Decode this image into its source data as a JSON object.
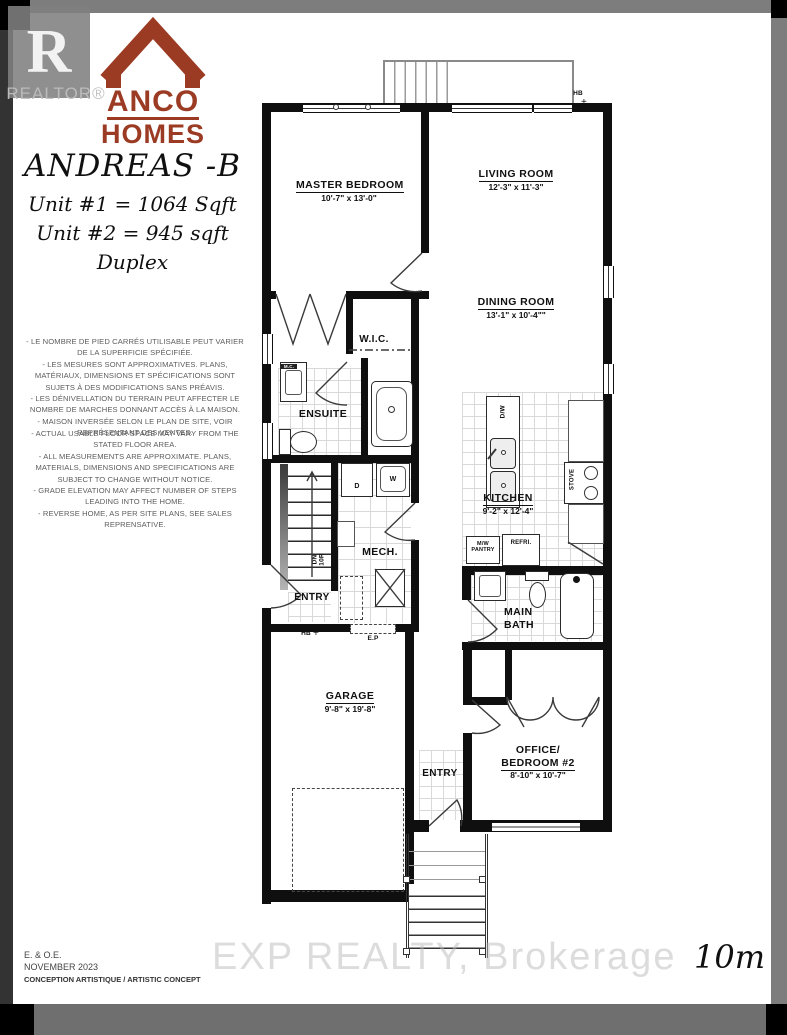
{
  "branding": {
    "realtor_r": "R",
    "realtor_label": "REALTOR®",
    "builder_name_line1": "ANCO",
    "builder_name_line2": "HOMES",
    "logo_color": "#9c3b23"
  },
  "titleblock": {
    "model_name": "ANDREAS -B",
    "unit1_area": "Unit #1 = 1064 Sqft",
    "unit2_area": "Unit #2 = 945 sqft",
    "plan_type": "Duplex"
  },
  "disclaimer": {
    "french": "- LE NOMBRE DE PIED CARRÉS UTILISABLE PEUT VARIER DE LA SUPERFICIE SPÉCIFIÉE.\n- LES MESURES SONT APPROXIMATIVES.  PLANS, MATÉRIAUX, DIMENSIONS ET SPÉCIFICATIONS SONT SUJETS À DES MODIFICATIONS SANS PRÉAVIS.\n- LES DÉNIVELLATION DU TERRAIN PEUT AFFECTER LE NOMBRE DE MARCHES DONNANT ACCÈS À LA MAISON.\n- MAISON INVERSÉE SELON LE PLAN DE SITE, VOIR REPRÉSENTANT DES VENTES.",
    "english": "- ACTUAL USABLE FLOOR SPACE MAY VARY FROM THE STATED FLOOR AREA.\n- ALL MEASUREMENTS ARE APPROXIMATE.  PLANS, MATERIALS, DIMENSIONS AND SPECIFICATIONS ARE SUBJECT TO CHANGE WITHOUT NOTICE.\n- GRADE ELEVATION MAY AFFECT NUMBER OF STEPS LEADING INTO THE HOME.\n- REVERSE HOME, AS PER SITE PLANS, SEE SALES REPRENSATIVE."
  },
  "rooms": {
    "master": {
      "name": "MASTER BEDROOM",
      "dims": "10'-7\" x 13'-0\""
    },
    "living": {
      "name": "LIVING ROOM",
      "dims": "12'-3\" x 11'-3\""
    },
    "dining": {
      "name": "DINING ROOM",
      "dims": "13'-1\" x 10'-4\"\""
    },
    "wic": {
      "name": "W.I.C."
    },
    "ensuite": {
      "name": "ENSUITE"
    },
    "kitchen": {
      "name": "KITCHEN",
      "dims": "9'-2\" x 12'-4\""
    },
    "mech": {
      "name": "MECH."
    },
    "entry_upper": {
      "name": "ENTRY"
    },
    "main_bath": {
      "name": "MAIN BATH"
    },
    "garage": {
      "name": "GARAGE",
      "dims": "9'-8\" x 19'-8\""
    },
    "office": {
      "name": "OFFICE/",
      "name2": "BEDROOM #2",
      "dims": "8'-10\" x 10'-7\""
    },
    "entry_lower": {
      "name": "ENTRY"
    }
  },
  "fixtures": {
    "dishwasher": "D/W",
    "stove": "STOVE",
    "pantry": "M/W\nPANTRY",
    "fridge": "REFRI.",
    "dryer": "D",
    "washer": "W",
    "stairs_label": "DN\n10R",
    "hose_bib": "HB",
    "elec_panel": "E.P",
    "medicine_cabinet": "M.C."
  },
  "footer": {
    "eoe": "E. & O.E.",
    "date": "NOVEMBER 2023",
    "concept": "CONCEPTION ARTISTIQUE / ARTISTIC CONCEPT",
    "scale": "10m",
    "watermark": "EXP REALTY, Brokerage"
  }
}
